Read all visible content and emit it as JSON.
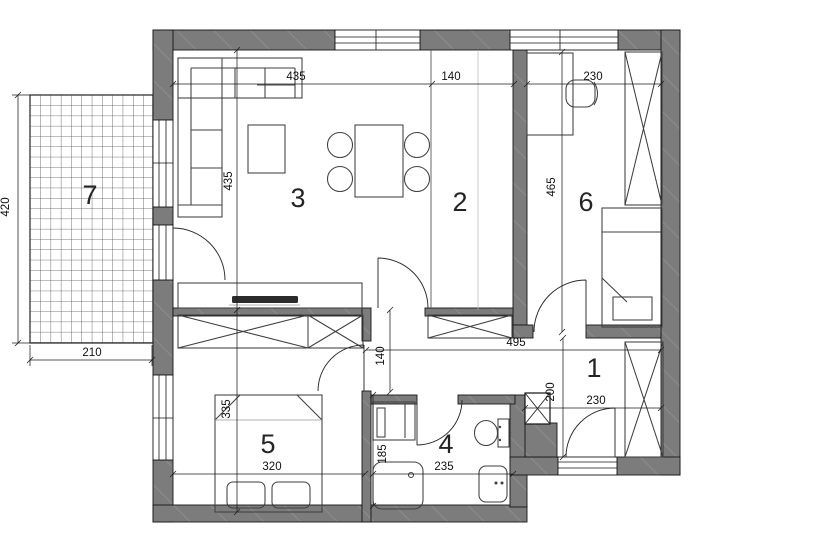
{
  "colors": {
    "wall": "#7c7c7c",
    "wall_hatch": "#929292",
    "grid_line": "#4f4f4f"
  },
  "rooms": {
    "r1": "1",
    "r2": "2",
    "r3": "3",
    "r4": "4",
    "r5": "5",
    "r6": "6",
    "r7": "7"
  },
  "dims": {
    "room3_width": "435",
    "kitchen_width": "140",
    "room6_width": "230",
    "room3_height": "435",
    "room6_height": "465",
    "terrace_height": "420",
    "terrace_width": "210",
    "hall_length": "495",
    "hall_width": "140",
    "entry_depth": "200",
    "entry_width": "230",
    "room5_height": "335",
    "room5_width": "320",
    "bath_height": "185",
    "bath_width": "235"
  }
}
